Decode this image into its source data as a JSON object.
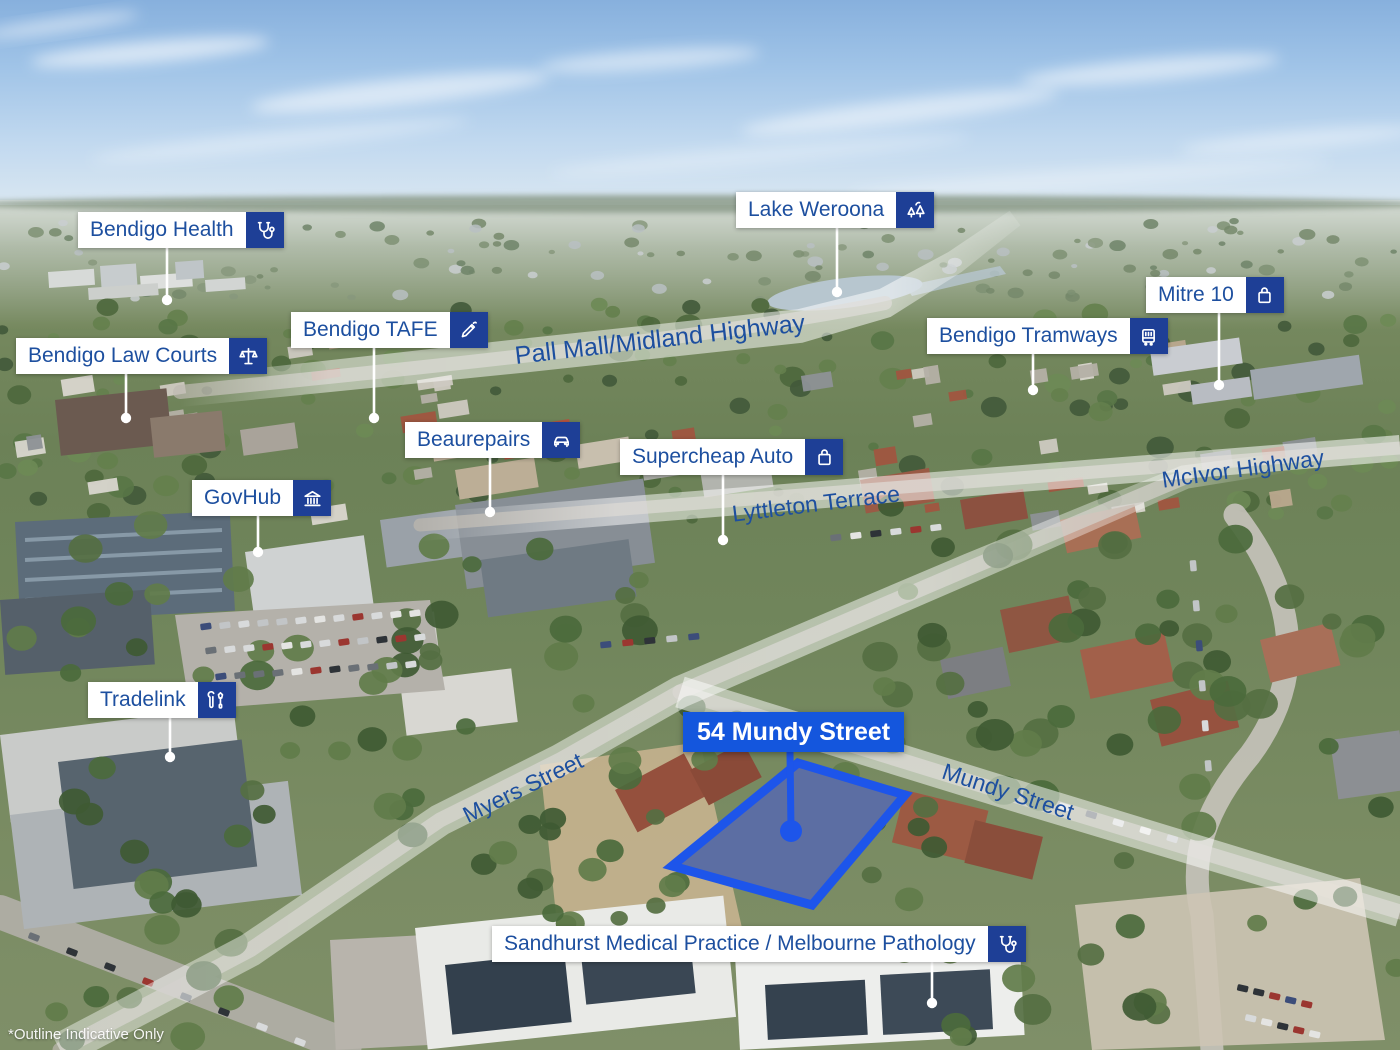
{
  "colors": {
    "label_text": "#1d4f9f",
    "label_bg": "#ffffff",
    "icon_tile_bg": "#1e3f96",
    "highlight_blue": "#1456dd",
    "outline_blue": "#1d55ea",
    "leader_line": "#ffffff"
  },
  "landmarks": [
    {
      "id": "bendigo-health",
      "label": "Bendigo Health",
      "icon": "stethoscope-icon",
      "x": 78,
      "y": 212,
      "leader": {
        "x": 167,
        "y1": 248,
        "y2": 300
      }
    },
    {
      "id": "lake-weroona",
      "label": "Lake Weroona",
      "icon": "trees-icon",
      "x": 736,
      "y": 192,
      "leader": {
        "x": 837,
        "y1": 228,
        "y2": 292
      }
    },
    {
      "id": "mitre-10",
      "label": "Mitre 10",
      "icon": "shopping-bag-icon",
      "x": 1146,
      "y": 277,
      "leader": {
        "x": 1219,
        "y1": 313,
        "y2": 385
      }
    },
    {
      "id": "bendigo-tafe",
      "label": "Bendigo TAFE",
      "icon": "pencil-icon",
      "x": 291,
      "y": 312,
      "leader": {
        "x": 374,
        "y1": 348,
        "y2": 418
      }
    },
    {
      "id": "bendigo-law-courts",
      "label": "Bendigo Law Courts",
      "icon": "scales-icon",
      "x": 16,
      "y": 338,
      "leader": {
        "x": 126,
        "y1": 374,
        "y2": 418
      }
    },
    {
      "id": "bendigo-tramways",
      "label": "Bendigo Tramways",
      "icon": "tram-icon",
      "x": 927,
      "y": 318,
      "leader": {
        "x": 1033,
        "y1": 354,
        "y2": 390
      }
    },
    {
      "id": "beaurepairs",
      "label": "Beaurepairs",
      "icon": "car-icon",
      "x": 405,
      "y": 422,
      "leader": {
        "x": 490,
        "y1": 458,
        "y2": 512
      }
    },
    {
      "id": "supercheap-auto",
      "label": "Supercheap Auto",
      "icon": "shopping-bag-icon",
      "x": 620,
      "y": 439,
      "leader": {
        "x": 723,
        "y1": 475,
        "y2": 540
      }
    },
    {
      "id": "govhub",
      "label": "GovHub",
      "icon": "bank-icon",
      "x": 192,
      "y": 480,
      "leader": {
        "x": 258,
        "y1": 516,
        "y2": 552
      }
    },
    {
      "id": "tradelink",
      "label": "Tradelink",
      "icon": "tools-icon",
      "x": 88,
      "y": 682,
      "leader": {
        "x": 170,
        "y1": 718,
        "y2": 757
      }
    },
    {
      "id": "sandhurst-medical",
      "label": "Sandhurst Medical Practice / Melbourne Pathology",
      "icon": "stethoscope-icon",
      "x": 492,
      "y": 926,
      "leader": {
        "x": 932,
        "y1": 962,
        "y2": 1003
      }
    }
  ],
  "property": {
    "label": "54 Mundy Street",
    "x": 683,
    "y": 712,
    "leader": {
      "x": 790,
      "y1": 752,
      "y2": 830
    },
    "outline_points": "798,763 905,795 812,905 672,866"
  },
  "streets": [
    {
      "id": "pall-mall-midland-highway",
      "label": "Pall Mall/Midland Highway",
      "x": 660,
      "y": 340,
      "rotate": -6.5,
      "size": 25
    },
    {
      "id": "lyttleton-terrace",
      "label": "Lyttleton Terrace",
      "x": 816,
      "y": 504,
      "rotate": -7,
      "size": 23
    },
    {
      "id": "mcivor-highway",
      "label": "McIvor Highway",
      "x": 1243,
      "y": 469,
      "rotate": -8,
      "size": 23
    },
    {
      "id": "myers-street",
      "label": "Myers Street",
      "x": 523,
      "y": 788,
      "rotate": -26,
      "size": 23
    },
    {
      "id": "mundy-street",
      "label": "Mundy Street",
      "x": 1008,
      "y": 792,
      "rotate": 18,
      "size": 23
    }
  ],
  "disclaimer": "*Outline Indicative Only"
}
